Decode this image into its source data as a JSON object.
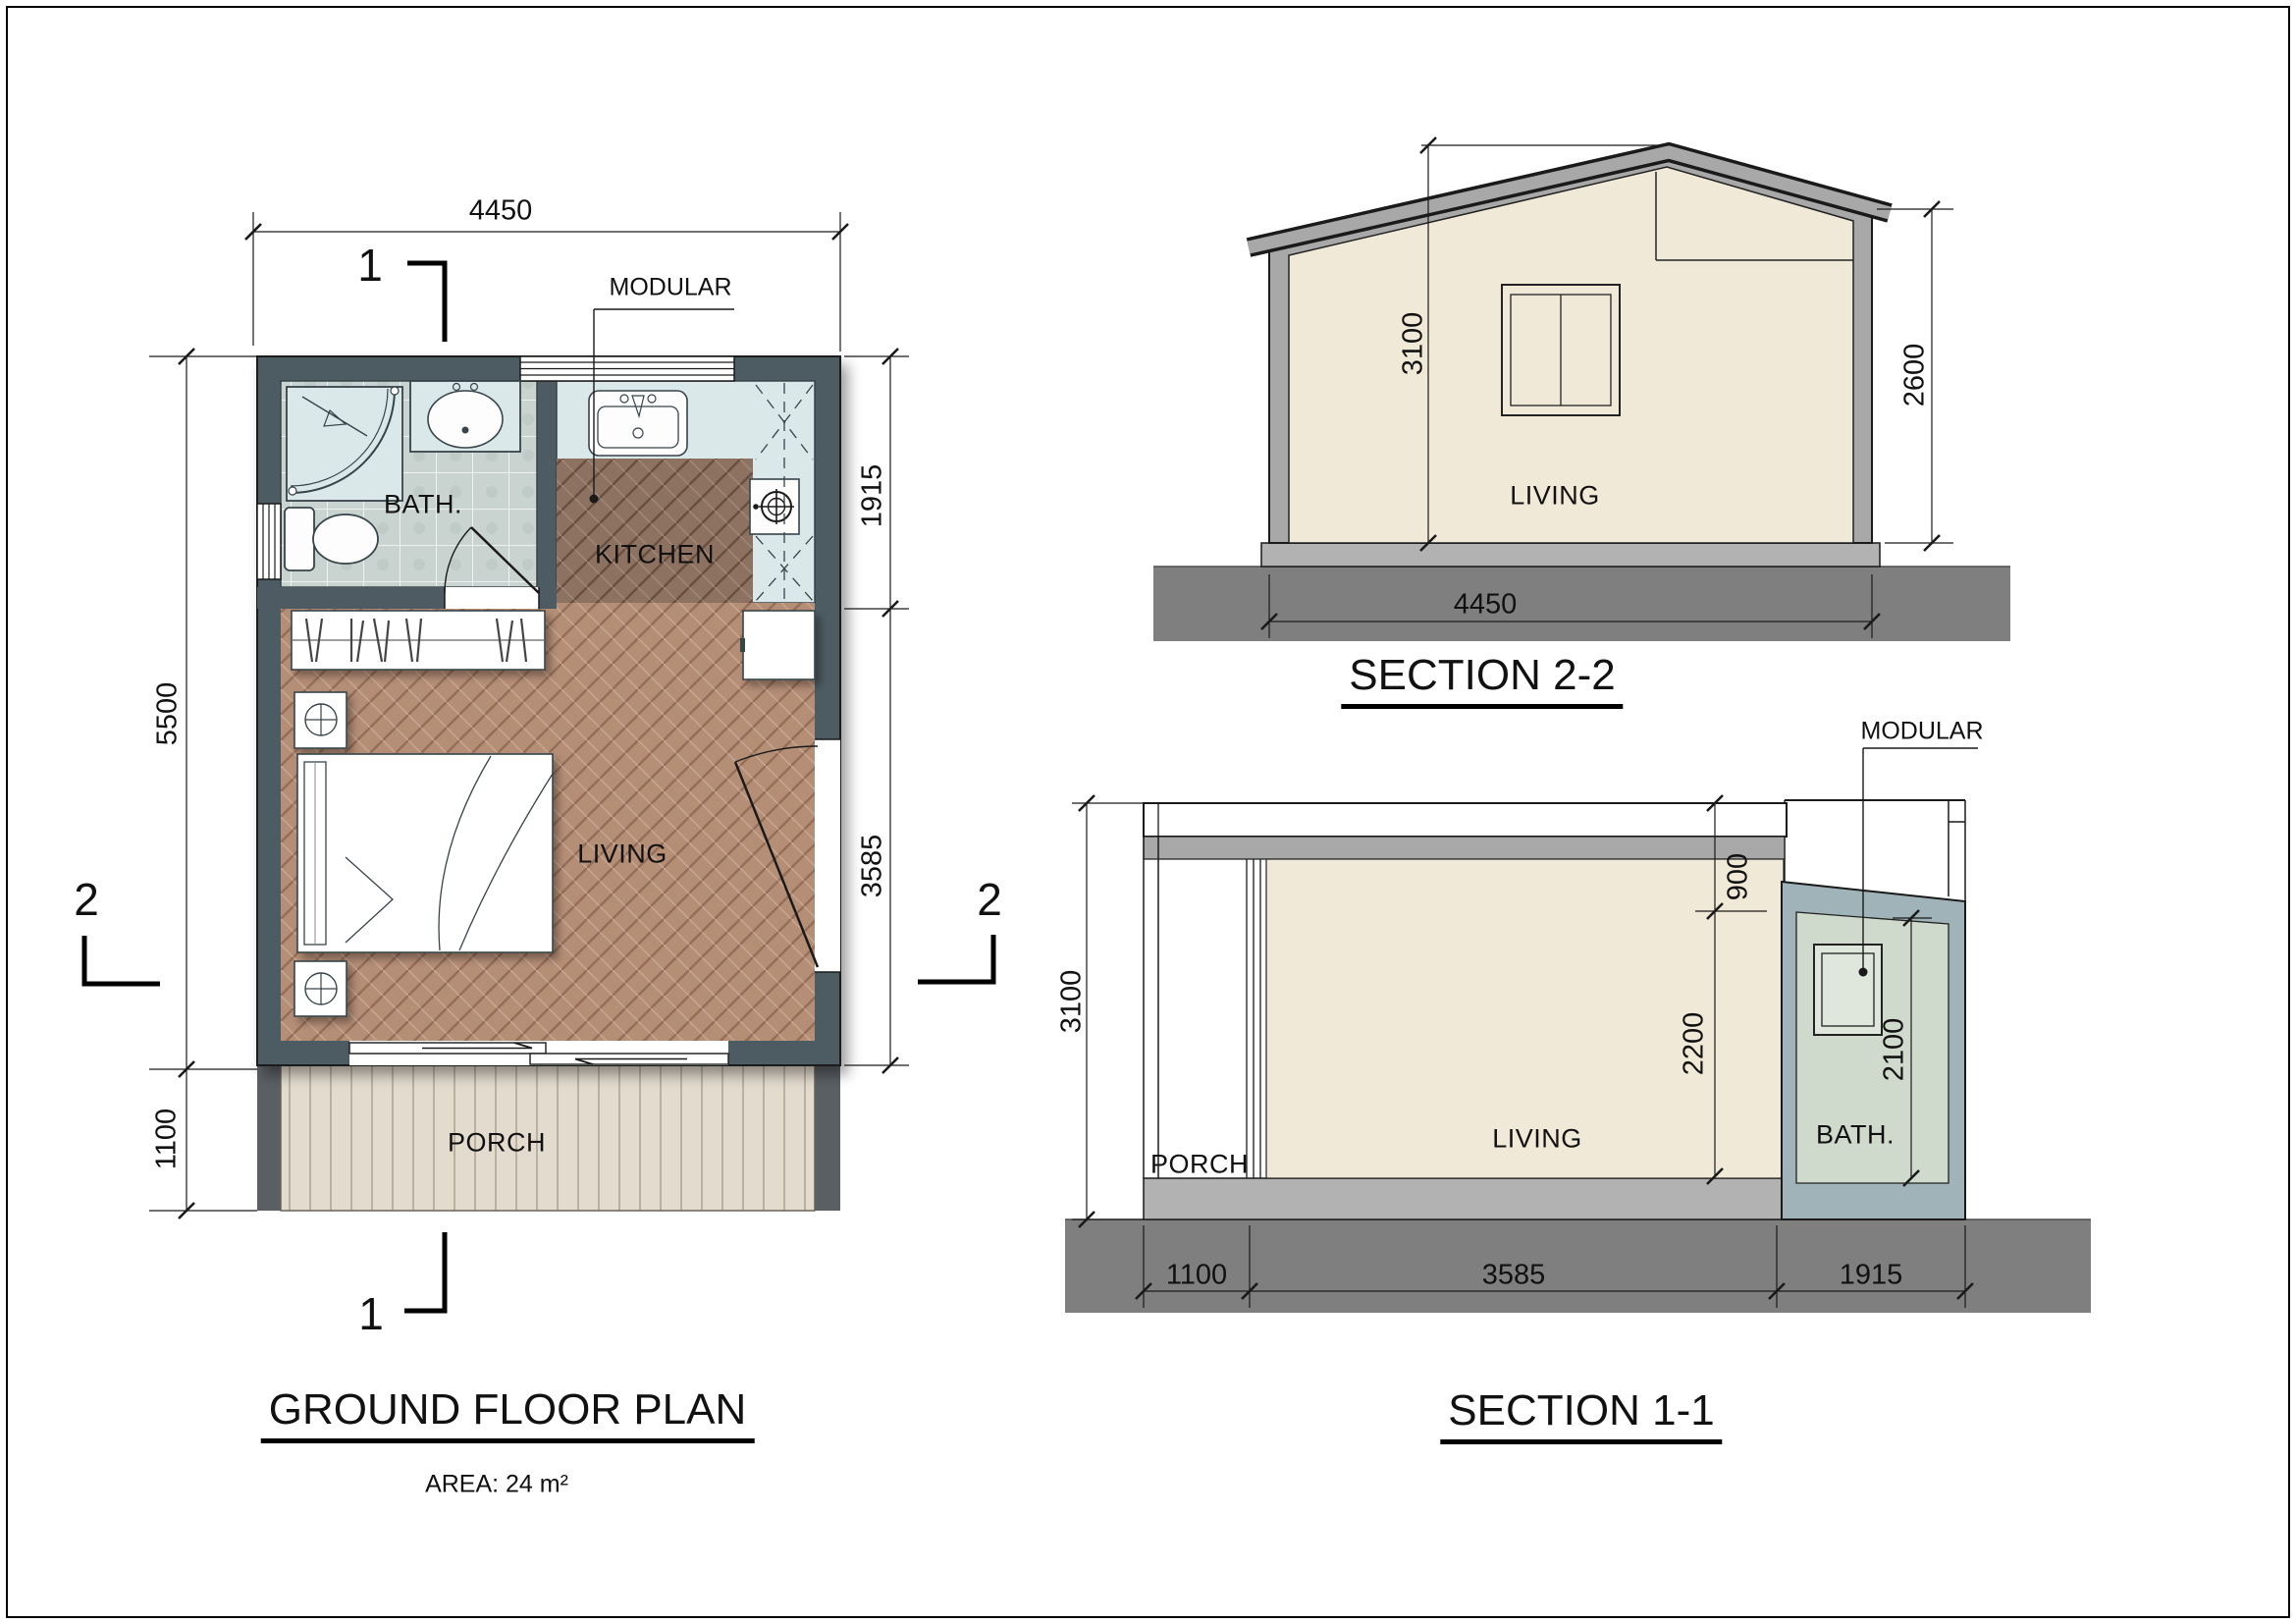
{
  "drawing": {
    "floor_plan": {
      "title": "GROUND FLOOR PLAN",
      "area": "AREA: 24 m²",
      "modular_label": "MODULAR",
      "rooms": {
        "bath": "BATH.",
        "kitchen": "KITCHEN",
        "living": "LIVING",
        "porch": "PORCH"
      },
      "dimensions": {
        "width_top": "4450",
        "height_left": "5500",
        "porch_left": "1100",
        "bath_kitchen_right": "1915",
        "living_right": "3585"
      },
      "section_markers": {
        "top": "1",
        "bottom": "1",
        "left": "2",
        "right": "2"
      }
    },
    "section_2_2": {
      "title": "SECTION 2-2",
      "room": "LIVING",
      "dimensions": {
        "peak_height": "3100",
        "eave_height": "2600",
        "width": "4450"
      }
    },
    "section_1_1": {
      "title": "SECTION 1-1",
      "modular_label": "MODULAR",
      "rooms": {
        "porch": "PORCH",
        "living": "LIVING",
        "bath": "BATH."
      },
      "dimensions": {
        "total_height": "3100",
        "roof_offset": "900",
        "living_clear_height": "2200",
        "bath_clear_height": "2100",
        "porch_width": "1100",
        "living_width": "3585",
        "bath_width": "1915"
      }
    },
    "colors": {
      "wall": "#4e5b63",
      "bath_tile": "#c9d4d0",
      "fixture_counter": "#dbe8ea",
      "kitchen_floor": "#8d7261",
      "living_floor": "#b58e76",
      "porch_deck": "#e2dbce",
      "section_wall": "#a8a8a8",
      "section_interior": "#f1e9d7",
      "bath_module_wall": "#9fb3b8",
      "bath_module_interior": "#cfdacd",
      "slab": "#b2b2b2",
      "ground": "#7f7f7f",
      "line": "#1a1a1a"
    }
  }
}
